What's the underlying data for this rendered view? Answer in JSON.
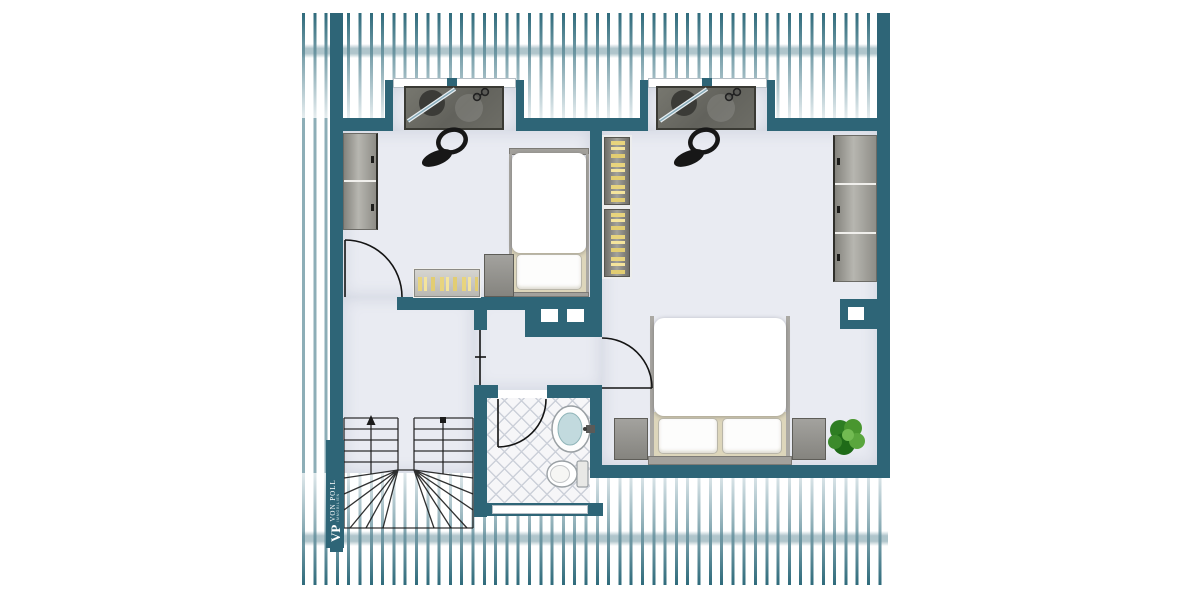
{
  "branding": {
    "initials": "VP",
    "name": "VON POLL",
    "subtitle": "IMMOBILIEN"
  },
  "palette": {
    "wall": "#2e6577",
    "stripe": "#2f6b7c",
    "floor": "#e9ebf2",
    "tile_bg": "#f6f6f8",
    "tile_line": "#ccd0d9",
    "band": "rgba(96,139,152,0.5)",
    "sheet_tan": "#ddd6bb",
    "book_yellow": "#e8d47d",
    "line": "#1b1b1b",
    "plant_green": "#3c8a2c"
  },
  "plan": {
    "type": "attic-floor-plan",
    "elements": [
      "roof-stripes",
      "dormer-window",
      "desk",
      "office-chair",
      "wardrobe",
      "single-bed",
      "double-bed",
      "nightstand",
      "bookshelf",
      "sideboard",
      "chimney",
      "staircase",
      "bathroom",
      "sink",
      "toilet",
      "plant",
      "door",
      "brand-logo"
    ]
  }
}
